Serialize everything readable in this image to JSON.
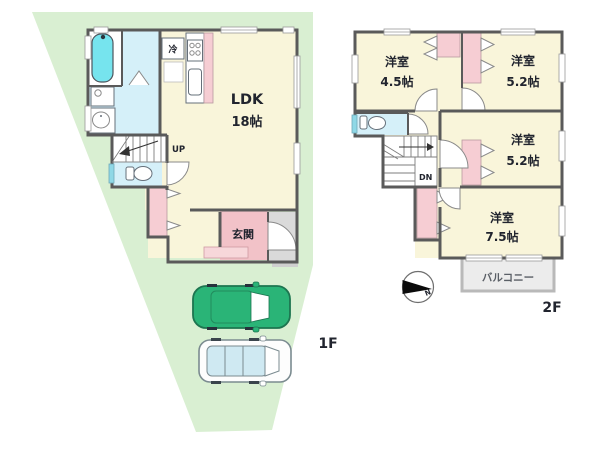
{
  "floor1": {
    "label": "1F",
    "ldk_name": "LDK",
    "ldk_size": "18帖",
    "fridge_label": "冷",
    "stairs_label": "UP",
    "entrance_label": "玄関"
  },
  "floor2": {
    "label": "2F",
    "rooms": [
      {
        "name": "洋室",
        "size": "4.5帖"
      },
      {
        "name": "洋室",
        "size": "5.2帖"
      },
      {
        "name": "洋室",
        "size": "5.2帖"
      },
      {
        "name": "洋室",
        "size": "7.5帖"
      }
    ],
    "stairs_label": "DN",
    "balcony_label": "バルコニー"
  },
  "compass": {
    "north_label": "N"
  },
  "colors": {
    "lot": "#d9efd2",
    "room": "#f9f5da",
    "closet": "#f6cdd3",
    "entrance": "#f2c2c8",
    "water": "#d5f0f9",
    "tub": "#76e4ee",
    "porch": "#dadada",
    "balcony": "#ececec",
    "wall": "#5a5a5a",
    "car_green": "#2ab477",
    "car_window": "#cfe9f2",
    "text": "#21242e"
  }
}
